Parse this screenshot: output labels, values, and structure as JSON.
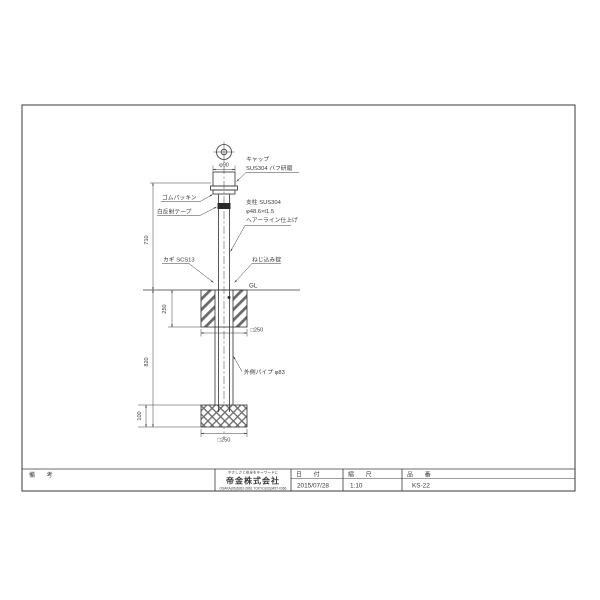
{
  "drawing": {
    "annotations": {
      "cap_line1": "キャップ",
      "cap_line2": "SUS304 バフ研磨",
      "cap_dia": "φ90",
      "rubber_packing": "ゴムパッキン",
      "reflective_tape": "白反射テープ",
      "post_line1": "支柱 SUS304",
      "post_line2": "φ48.6×t1.5",
      "post_line3": "ヘアーライン仕上げ",
      "key": "カギ SCS13",
      "screw_lock": "ねじ込み錠",
      "ground_level": "GL",
      "outer_pipe": "外側パイプ φ83"
    },
    "dimensions": {
      "height_above_ground": "710",
      "foundation_height": "250",
      "depth_below_ground": "820",
      "footing_height": "100",
      "foundation_width": "□250",
      "footing_width": "□250"
    },
    "line_color": "#3a3a3a"
  },
  "title_block": {
    "remarks_label": "備 考",
    "company": {
      "slogan": "やさしさと安全をキーワードに",
      "name": "帝金株式会社",
      "phone": "OSAKA(06)6262-2861 TOKYO(03)3457-0366"
    },
    "date_label": "日 付",
    "date_value": "2015/07/28",
    "scale_label": "縮 尺",
    "scale_value": "1:10",
    "part_label": "品 番",
    "part_value": "KS-22"
  }
}
